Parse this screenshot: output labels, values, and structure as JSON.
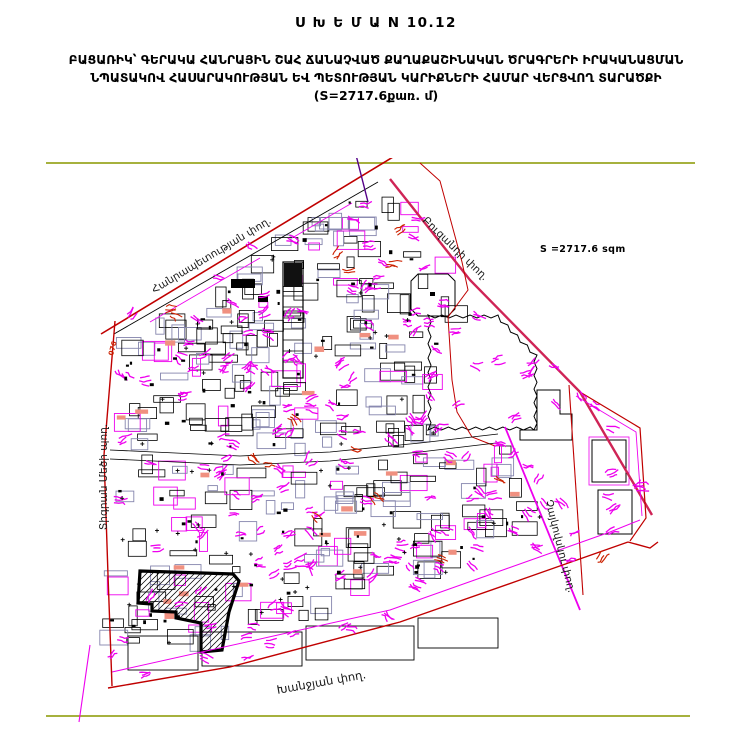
{
  "title": {
    "scheme": "Ս Խ Ե Մ Ա N 10.12",
    "line2": "ԲԱՑԱՌԻԿ՝ ԳԵՐԱԿԱ ՀԱՆՐԱՅԻՆ ՇԱՀ ՃԱՆԱՉՎԱԾ ՔԱՂԱՔԱՇԻՆԱԿԱՆ ԾՐԱԳՐԵՐԻ ԻՐԱԿԱՆԱՑՄԱՆ",
    "line3": "ՆՊԱՏԱԿՈՎ ՀԱՍԱՐԱԿՈՒԹՅԱՆ ԵՎ ՊԵՏՈՒԹՅԱՆ ԿԱՐԻՔՆԵՐԻ ՀԱՄԱՐ ՎԵՐՑՎՈՂ ՏԱՐԱԾՔԻ",
    "line4": "(S=2717.6քառ. մ)"
  },
  "map": {
    "area_label": "S =2717.6 sqm",
    "edge_label": "076",
    "streets": {
      "hanrapetutyan": "Հանրապետության փող.",
      "buzandi": "Բուզանդի փող.",
      "tigran_mets": "Տիգրան Մեծի պող.",
      "khanjyan": "Խանջյան փող.",
      "tchaikovsky": "Չայկովսկու փող."
    },
    "colors": {
      "street_red": "#c00000",
      "highlight_crimson": "#cf2456",
      "parcel_magenta": "#ee00ee",
      "parcel_gray": "#8585ad",
      "boundary_olive": "#9aa623",
      "salmon_fill": "#f09080",
      "hatch_black": "#000000"
    }
  }
}
